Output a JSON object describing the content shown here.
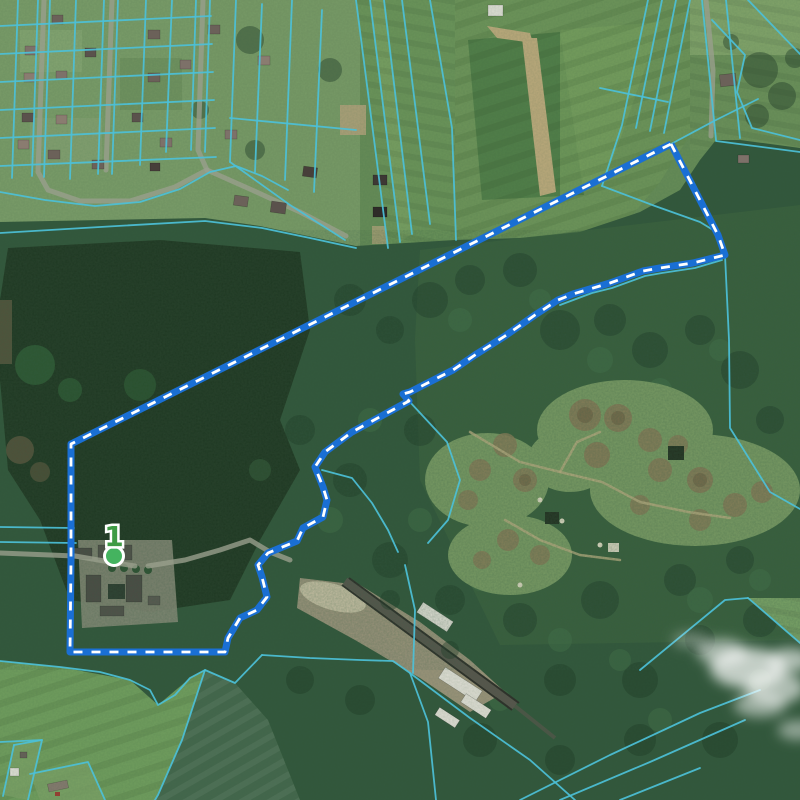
{
  "map": {
    "type": "satellite-cadastral-map",
    "marker": {
      "label": "1",
      "label_color": "#3f9b45",
      "dot_color": "#44b35f",
      "dot_outline": "#ffffff"
    },
    "selection": {
      "stroke_color": "#1a6fd4",
      "dash_color": "#ffffff",
      "outline": [
        [
          671,
          144
        ],
        [
          718,
          235
        ],
        [
          725,
          255
        ],
        [
          693,
          263
        ],
        [
          660,
          268
        ],
        [
          643,
          271
        ],
        [
          610,
          283
        ],
        [
          573,
          294
        ],
        [
          558,
          300
        ],
        [
          535,
          315
        ],
        [
          505,
          336
        ],
        [
          475,
          355
        ],
        [
          453,
          370
        ],
        [
          410,
          392
        ],
        [
          403,
          394
        ],
        [
          409,
          401
        ],
        [
          352,
          432
        ],
        [
          325,
          452
        ],
        [
          315,
          467
        ],
        [
          323,
          487
        ],
        [
          327,
          500
        ],
        [
          323,
          517
        ],
        [
          303,
          528
        ],
        [
          297,
          541
        ],
        [
          268,
          553
        ],
        [
          258,
          565
        ],
        [
          262,
          577
        ],
        [
          267,
          597
        ],
        [
          257,
          610
        ],
        [
          240,
          618
        ],
        [
          228,
          638
        ],
        [
          225,
          652
        ],
        [
          70,
          652
        ],
        [
          71,
          560
        ],
        [
          71,
          444
        ],
        [
          671,
          144
        ]
      ]
    },
    "cadastral": {
      "color": "#4cc0d8",
      "lines": [
        [
          [
            18,
            0
          ],
          [
            12,
            178
          ]
        ],
        [
          [
            38,
            0
          ],
          [
            32,
            176
          ]
        ],
        [
          [
            50,
            0
          ],
          [
            44,
            177
          ]
        ],
        [
          [
            76,
            0
          ],
          [
            70,
            179
          ]
        ],
        [
          [
            104,
            0
          ],
          [
            98,
            174
          ]
        ],
        [
          [
            118,
            0
          ],
          [
            112,
            174
          ]
        ],
        [
          [
            146,
            0
          ],
          [
            140,
            165
          ]
        ],
        [
          [
            172,
            0
          ],
          [
            166,
            152
          ]
        ],
        [
          [
            196,
            0
          ],
          [
            191,
            150
          ]
        ],
        [
          [
            210,
            0
          ],
          [
            205,
            152
          ]
        ],
        [
          [
            236,
            0
          ],
          [
            230,
            162
          ]
        ],
        [
          [
            0,
            26
          ],
          [
            211,
            16
          ]
        ],
        [
          [
            0,
            54
          ],
          [
            212,
            44
          ]
        ],
        [
          [
            0,
            82
          ],
          [
            213,
            72
          ]
        ],
        [
          [
            0,
            110
          ],
          [
            214,
            100
          ]
        ],
        [
          [
            0,
            138
          ],
          [
            215,
            128
          ]
        ],
        [
          [
            0,
            166
          ],
          [
            216,
            157
          ]
        ],
        [
          [
            0,
            192
          ],
          [
            45,
            200
          ],
          [
            95,
            206
          ],
          [
            140,
            202
          ],
          [
            180,
            189
          ],
          [
            210,
            172
          ],
          [
            236,
            166
          ],
          [
            262,
            176
          ],
          [
            288,
            190
          ]
        ],
        [
          [
            0,
            233
          ],
          [
            100,
            227
          ],
          [
            205,
            221
          ],
          [
            262,
            228
          ],
          [
            310,
            238
          ],
          [
            356,
            248
          ]
        ],
        [
          [
            262,
            4
          ],
          [
            255,
            172
          ]
        ],
        [
          [
            292,
            0
          ],
          [
            285,
            180
          ]
        ],
        [
          [
            322,
            10
          ],
          [
            314,
            192
          ]
        ],
        [
          [
            230,
            118
          ],
          [
            356,
            130
          ]
        ],
        [
          [
            230,
            162
          ],
          [
            290,
            205
          ],
          [
            345,
            240
          ]
        ],
        [
          [
            356,
            0
          ],
          [
            388,
            248
          ]
        ],
        [
          [
            370,
            0
          ],
          [
            400,
            242
          ]
        ],
        [
          [
            384,
            0
          ],
          [
            412,
            234
          ]
        ],
        [
          [
            402,
            0
          ],
          [
            430,
            224
          ]
        ],
        [
          [
            430,
            0
          ],
          [
            452,
            128
          ],
          [
            456,
            240
          ]
        ],
        [
          [
            648,
            0
          ],
          [
            622,
            125
          ],
          [
            602,
            186
          ]
        ],
        [
          [
            662,
            0
          ],
          [
            636,
            128
          ]
        ],
        [
          [
            676,
            0
          ],
          [
            650,
            131
          ]
        ],
        [
          [
            690,
            0
          ],
          [
            664,
            133
          ]
        ],
        [
          [
            600,
            88
          ],
          [
            668,
            102
          ]
        ],
        [
          [
            602,
            186
          ],
          [
            655,
            206
          ],
          [
            700,
            222
          ],
          [
            718,
            233
          ]
        ],
        [
          [
            702,
            0
          ],
          [
            716,
            140
          ]
        ],
        [
          [
            726,
            0
          ],
          [
            740,
            138
          ]
        ],
        [
          [
            712,
            20
          ],
          [
            745,
            55
          ],
          [
            737,
            92
          ],
          [
            752,
            128
          ],
          [
            800,
            140
          ]
        ],
        [
          [
            748,
            0
          ],
          [
            800,
            54
          ]
        ],
        [
          [
            716,
            141
          ],
          [
            800,
            152
          ]
        ],
        [
          [
            671,
            144
          ],
          [
            714,
            121
          ],
          [
            758,
            99
          ]
        ],
        [
          [
            725,
            255
          ],
          [
            729,
            340
          ],
          [
            730,
            428
          ],
          [
            770,
            492
          ],
          [
            800,
            509
          ]
        ],
        [
          [
            560,
            305
          ],
          [
            592,
            293
          ],
          [
            612,
            288
          ],
          [
            645,
            276
          ],
          [
            662,
            273
          ],
          [
            695,
            268
          ],
          [
            722,
            260
          ]
        ],
        [
          [
            409,
            401
          ],
          [
            447,
            442
          ],
          [
            460,
            480
          ],
          [
            448,
            520
          ],
          [
            428,
            543
          ]
        ],
        [
          [
            322,
            470
          ],
          [
            352,
            478
          ],
          [
            372,
            503
          ],
          [
            388,
            530
          ],
          [
            398,
            552
          ]
        ],
        [
          [
            262,
            655
          ],
          [
            310,
            658
          ],
          [
            360,
            660
          ],
          [
            393,
            661
          ],
          [
            410,
            673
          ]
        ],
        [
          [
            410,
            673
          ],
          [
            428,
            722
          ],
          [
            436,
            800
          ]
        ],
        [
          [
            410,
            673
          ],
          [
            470,
            718
          ],
          [
            530,
            760
          ],
          [
            575,
            800
          ]
        ],
        [
          [
            413,
            673
          ],
          [
            415,
            610
          ],
          [
            405,
            565
          ]
        ],
        [
          [
            0,
            661
          ],
          [
            60,
            667
          ],
          [
            100,
            672
          ],
          [
            130,
            680
          ],
          [
            150,
            690
          ],
          [
            158,
            705
          ],
          [
            175,
            695
          ],
          [
            190,
            678
          ],
          [
            205,
            670
          ],
          [
            235,
            683
          ],
          [
            262,
            655
          ]
        ],
        [
          [
            205,
            670
          ],
          [
            182,
            740
          ],
          [
            158,
            795
          ],
          [
            155,
            800
          ]
        ],
        [
          [
            0,
            742
          ],
          [
            42,
            740
          ]
        ],
        [
          [
            14,
            745
          ],
          [
            42,
            740
          ],
          [
            28,
            800
          ]
        ],
        [
          [
            14,
            745
          ],
          [
            3,
            796
          ]
        ],
        [
          [
            30,
            774
          ],
          [
            88,
            762
          ],
          [
            105,
            800
          ]
        ],
        [
          [
            0,
            527
          ],
          [
            74,
            528
          ]
        ],
        [
          [
            0,
            542
          ],
          [
            76,
            543
          ]
        ],
        [
          [
            640,
            670
          ],
          [
            725,
            600
          ],
          [
            748,
            598
          ]
        ],
        [
          [
            748,
            598
          ],
          [
            800,
            643
          ]
        ],
        [
          [
            520,
            800
          ],
          [
            610,
            755
          ],
          [
            700,
            713
          ],
          [
            760,
            690
          ]
        ],
        [
          [
            560,
            800
          ],
          [
            650,
            762
          ],
          [
            745,
            720
          ]
        ],
        [
          [
            620,
            800
          ],
          [
            700,
            768
          ]
        ]
      ]
    },
    "roads": {
      "color": "#989f8c",
      "lines": [
        [
          [
            44,
            0
          ],
          [
            38,
            172
          ],
          [
            48,
            190
          ],
          [
            80,
            201
          ],
          [
            130,
            201
          ],
          [
            175,
            187
          ],
          [
            207,
            170
          ]
        ],
        [
          [
            112,
            0
          ],
          [
            106,
            170
          ]
        ],
        [
          [
            203,
            0
          ],
          [
            198,
            150
          ],
          [
            207,
            170
          ]
        ],
        [
          [
            207,
            170
          ],
          [
            252,
            190
          ],
          [
            300,
            212
          ],
          [
            346,
            236
          ]
        ],
        [
          [
            0,
            553
          ],
          [
            75,
            556
          ],
          [
            110,
            562
          ],
          [
            135,
            566
          ]
        ],
        [
          [
            148,
            566
          ],
          [
            185,
            560
          ],
          [
            220,
            550
          ],
          [
            250,
            540
          ],
          [
            270,
            552
          ],
          [
            290,
            560
          ]
        ],
        [
          [
            706,
            0
          ],
          [
            713,
            70
          ],
          [
            711,
            136
          ]
        ]
      ]
    }
  }
}
